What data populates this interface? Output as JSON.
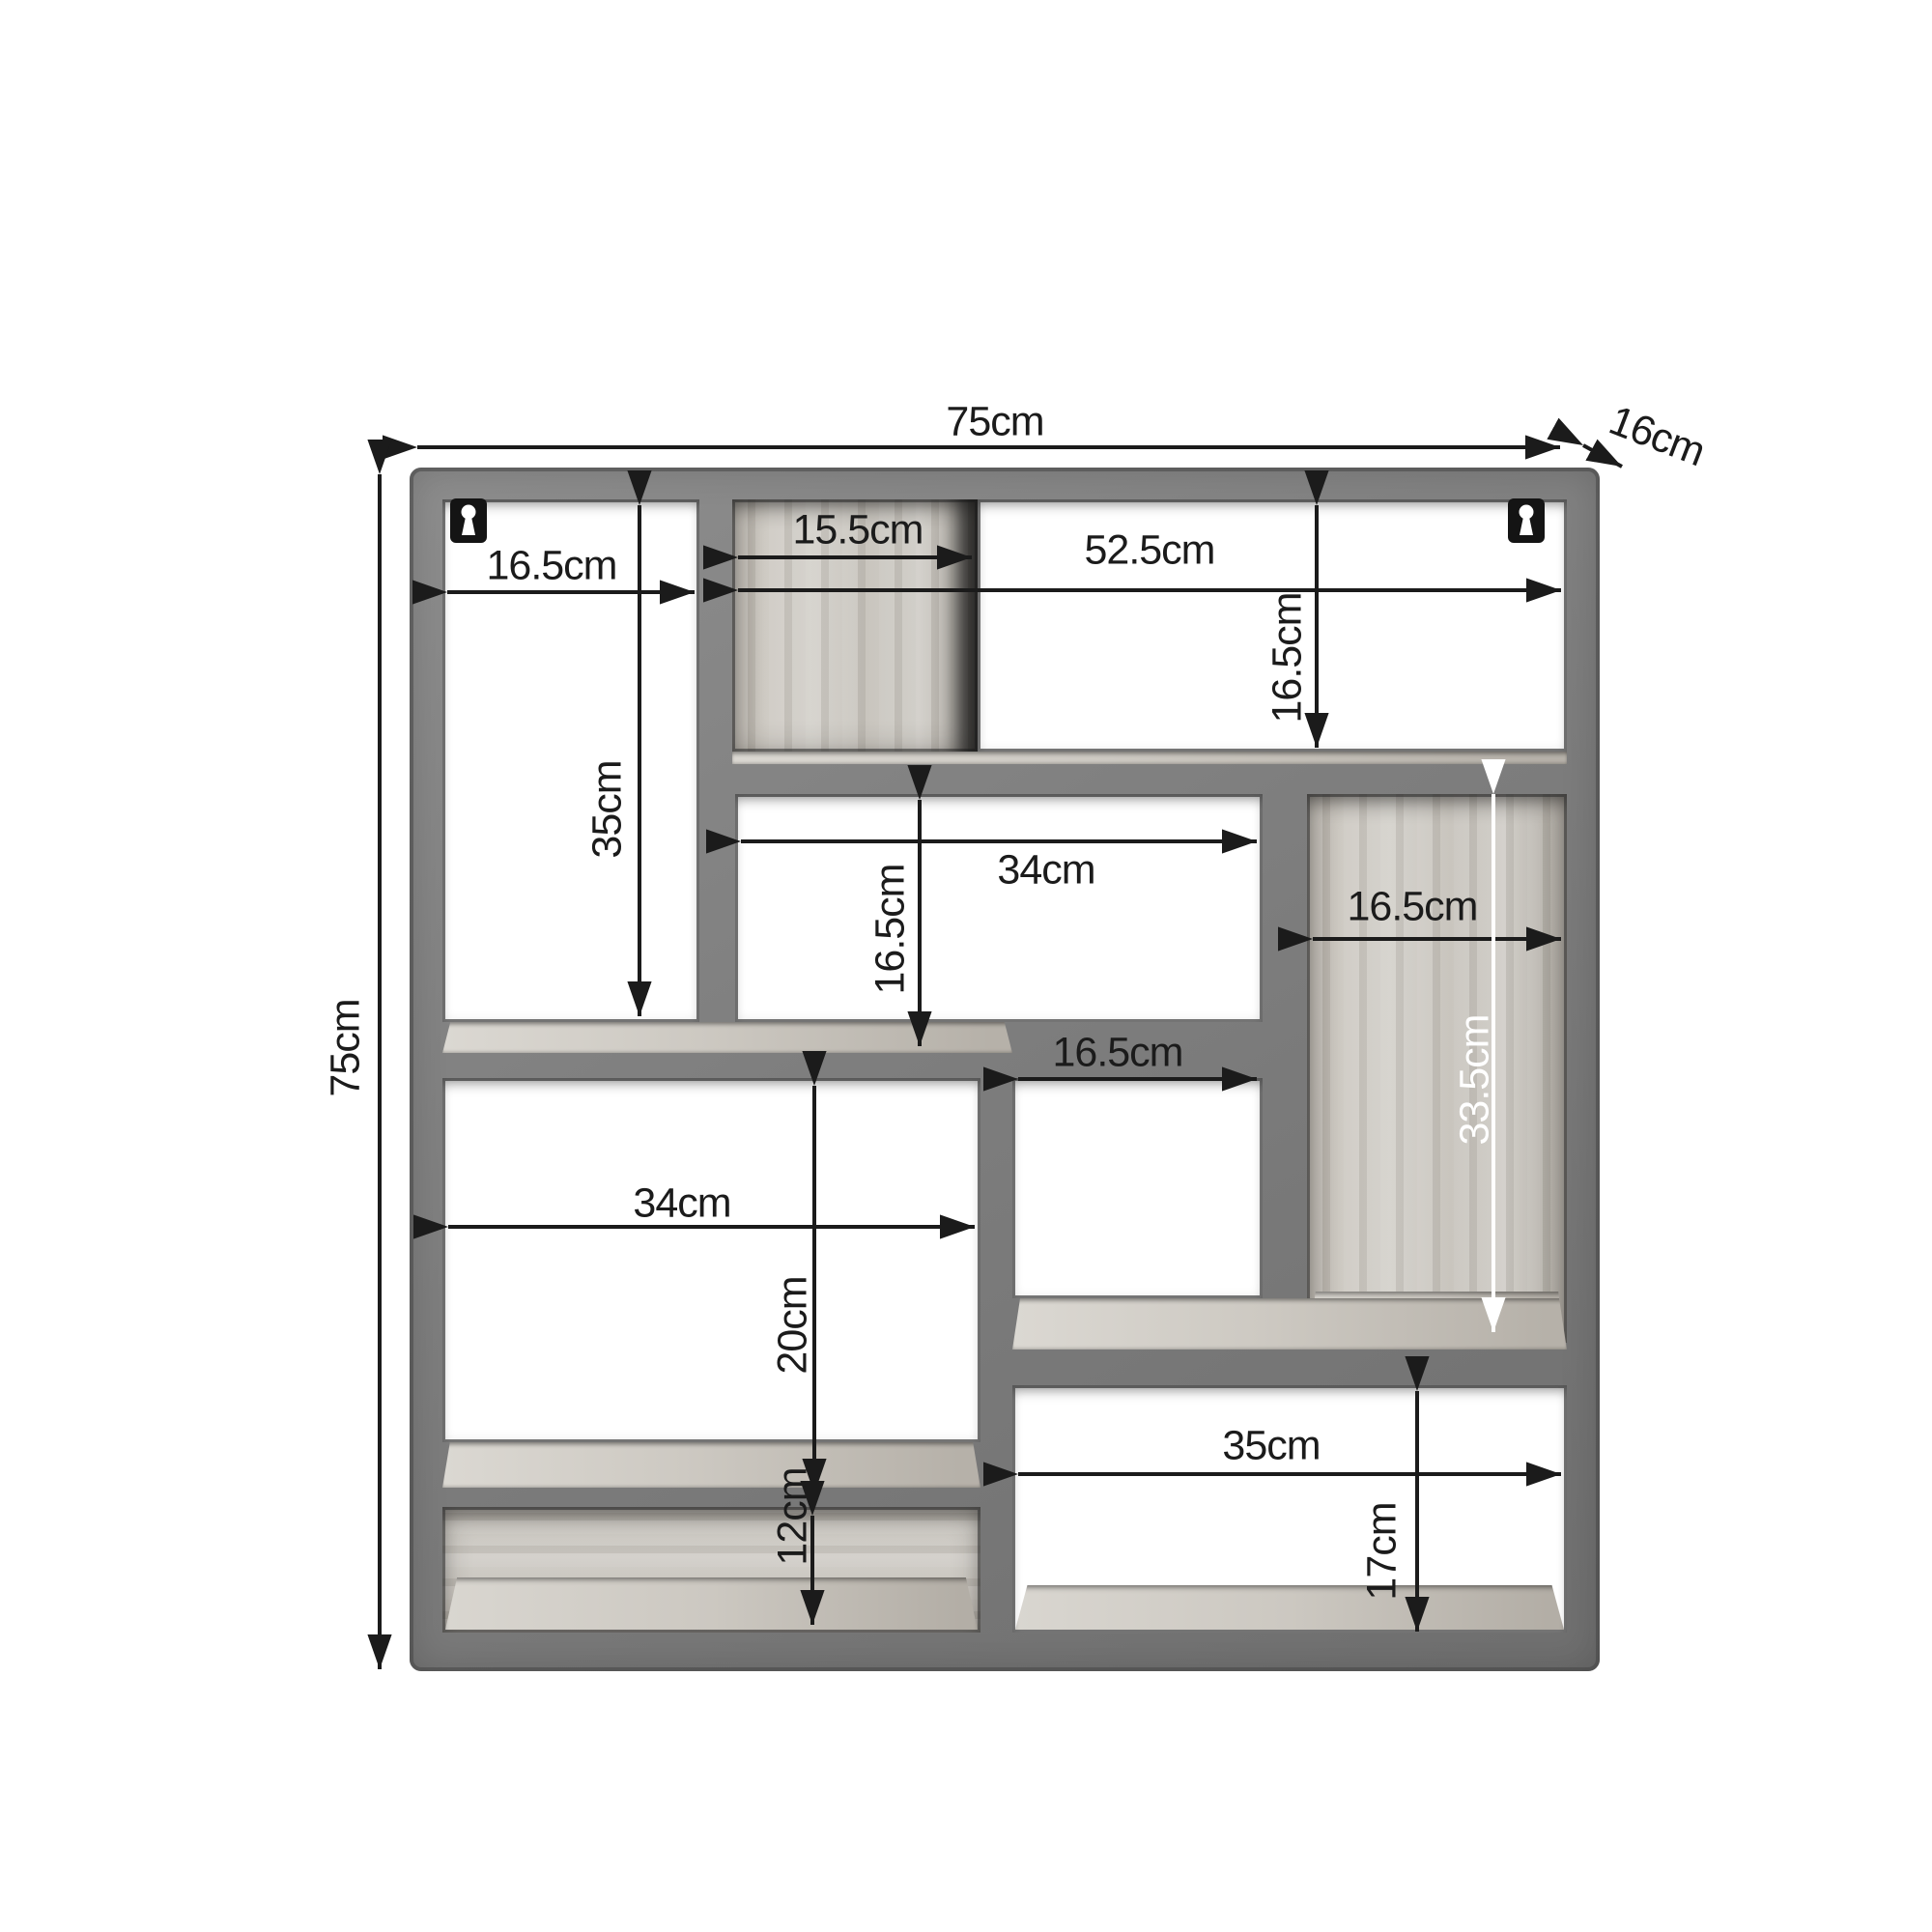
{
  "diagram": {
    "kind": "product dimension diagram",
    "subject": "square wall shelf unit with staggered compartments",
    "unit": "cm"
  },
  "colors": {
    "background": "#ffffff",
    "frame_grey": "#7e7e7e",
    "wood_tone": "#c9c5be",
    "dimension_ink": "#1b1b1b",
    "dimension_ink_light": "#ffffff"
  },
  "icons": {
    "keyhole_hanger": "keyhole-hanger"
  },
  "dimensions": {
    "overall_width": "75cm",
    "overall_depth": "16cm",
    "overall_height": "75cm",
    "top_left_width": "16.5cm",
    "top_panel_width": "15.5cm",
    "top_right_width": "52.5cm",
    "top_right_height": "16.5cm",
    "left_column_height": "35cm",
    "middle_width": "34cm",
    "middle_height": "16.5cm",
    "right_column_width": "16.5cm",
    "step_width": "16.5cm",
    "right_column_height": "33.5cm",
    "lower_left_width": "34cm",
    "lower_left_height": "20cm",
    "bottom_left_height": "12cm",
    "bottom_right_width": "35cm",
    "bottom_right_height": "17cm"
  }
}
